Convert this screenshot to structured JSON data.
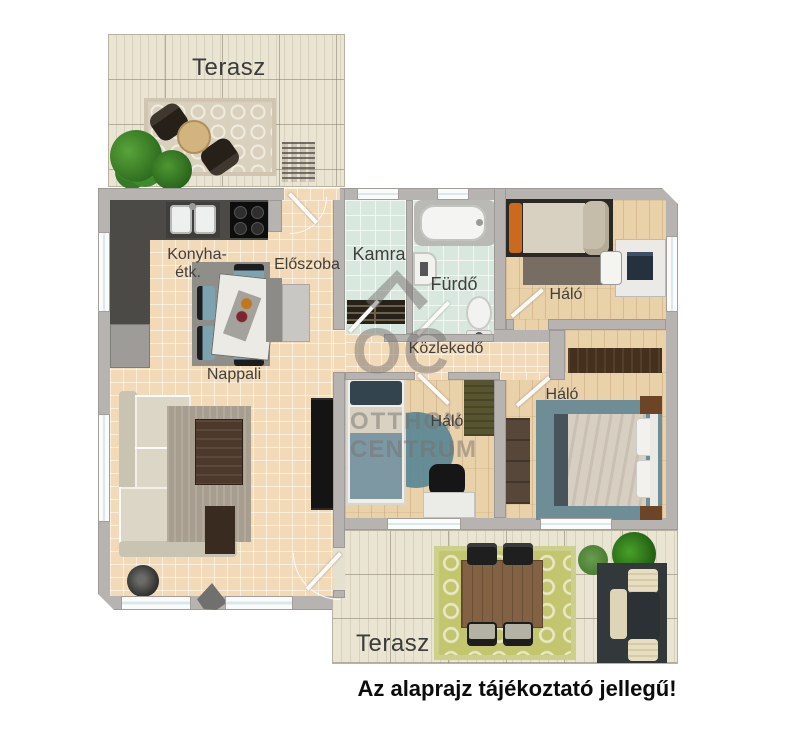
{
  "disclaimer": "Az alaprajz tájékoztató jellegű!",
  "rooms": {
    "terrace_top": {
      "label": "Terasz"
    },
    "kitchen_dining": {
      "label_line1": "Konyha-",
      "label_line2": "étk."
    },
    "entry_hall": {
      "label": "Előszoba"
    },
    "pantry": {
      "label": "Kamra"
    },
    "bathroom": {
      "label": "Fürdő"
    },
    "bedroom_top_right": {
      "label": "Háló"
    },
    "corridor": {
      "label": "Közlekedő"
    },
    "bedroom_middle": {
      "label": "Háló"
    },
    "bedroom_bottom_right": {
      "label": "Háló"
    },
    "living_room": {
      "label": "Nappali"
    },
    "terrace_bottom": {
      "label": "Terasz"
    }
  },
  "watermark": {
    "monogram": "OC",
    "line1": "OTTHON",
    "line2": "CENTRUM"
  },
  "colors": {
    "wall": "#b6b3b0",
    "tile_floor": "#f2dab9",
    "wood_floor": "#e9d1aa",
    "bath_tile": "#d9e8df",
    "terrace_floor": "#eae4d3",
    "kitchen_counter": "#4b4a47",
    "chair_teal": "#7da3b0",
    "rug_green": "#c3c66f",
    "rug_teal": "#6e8d96",
    "watermark_gray": "#76736e",
    "label_text": "#413f3d"
  }
}
